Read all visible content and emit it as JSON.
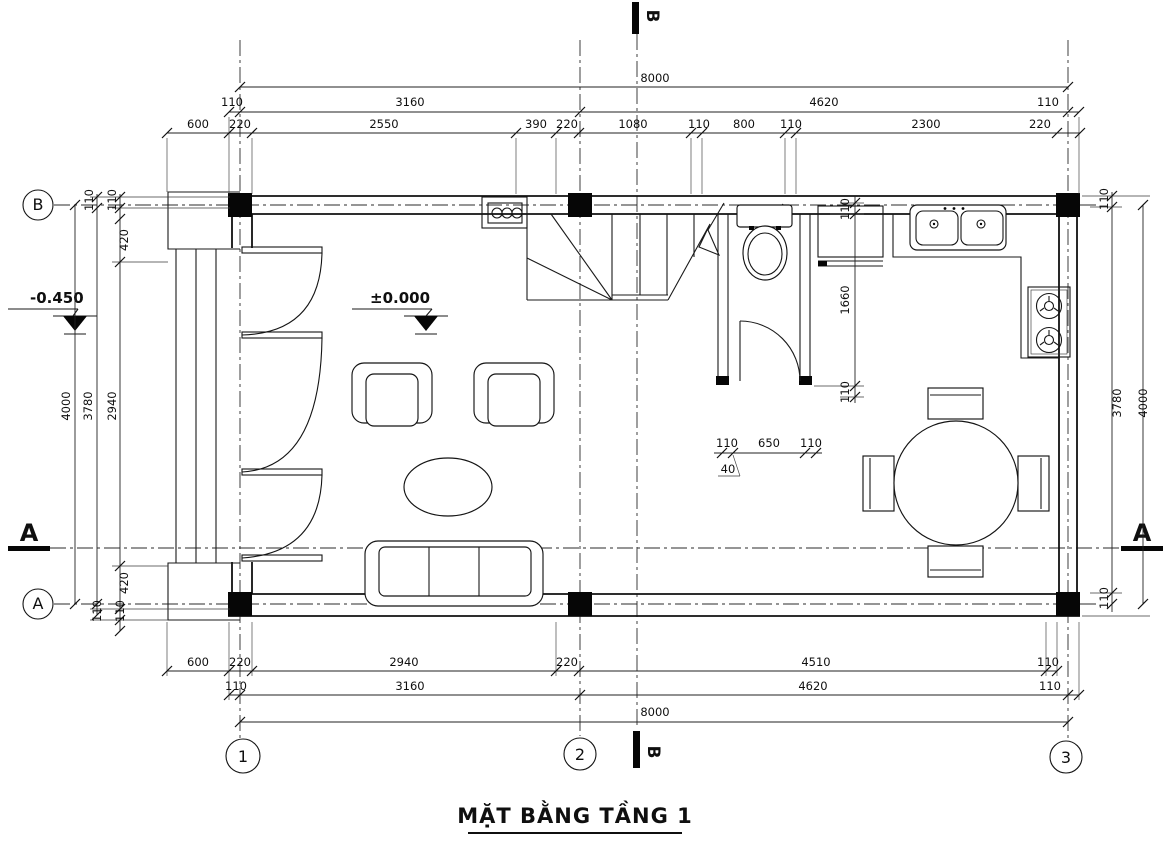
{
  "title": "MẶT BẰNG TẦNG 1",
  "grid": {
    "row_b": "B",
    "row_a": "A",
    "col_1": "1",
    "col_2": "2",
    "col_3": "3"
  },
  "sections": {
    "top": "B",
    "bottom": "B",
    "left": "A",
    "right": "A"
  },
  "levels": {
    "porch": "-0.450",
    "floor": "±0.000"
  },
  "dims": {
    "top1": [
      "8000"
    ],
    "top2": [
      "110",
      "3160",
      "4620",
      "110"
    ],
    "top3": [
      "600",
      "220",
      "2550",
      "390",
      "220",
      "1080",
      "110",
      "800",
      "110",
      "2300",
      "220"
    ],
    "bottom1": [
      "600",
      "220",
      "2940",
      "220",
      "4510",
      "110"
    ],
    "bottom2": [
      "110",
      "3160",
      "4620",
      "110"
    ],
    "bottom3": [
      "8000"
    ],
    "left": [
      "110",
      "110",
      "420",
      "2940",
      "3780",
      "4000",
      "420",
      "110",
      "110"
    ],
    "right": [
      "110",
      "3780",
      "110",
      "4000"
    ],
    "wc": [
      "110",
      "1660",
      "110"
    ],
    "wcdoor": [
      "110",
      "650",
      "110",
      "40"
    ]
  }
}
